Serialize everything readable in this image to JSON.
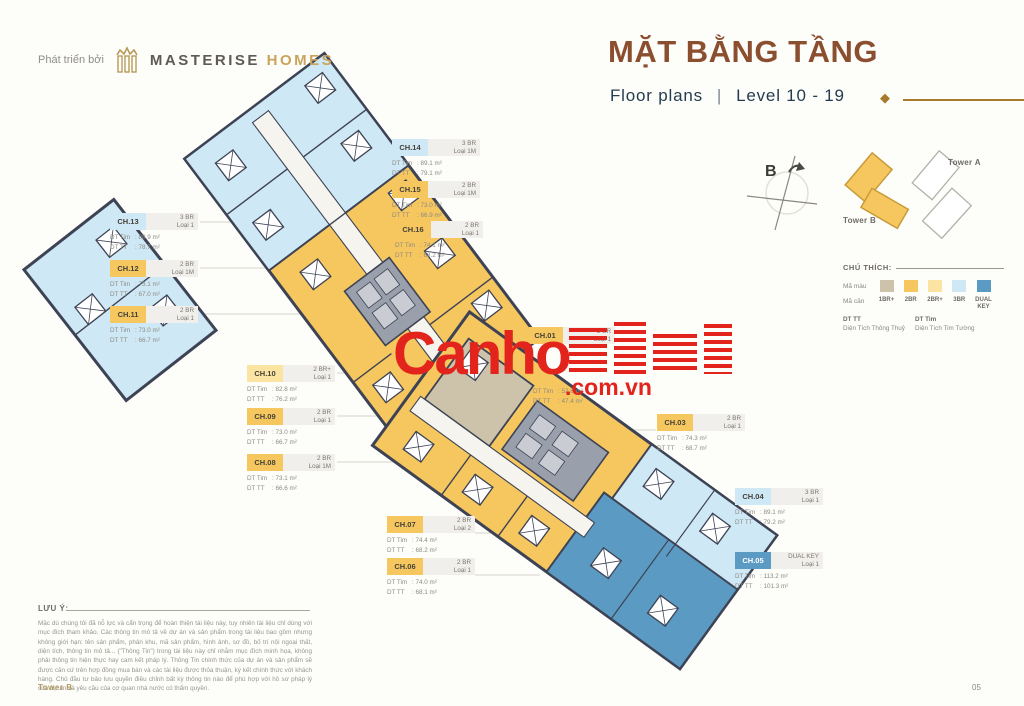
{
  "page": {
    "developer_prefix": "Phát triển bởi",
    "brand_primary": "MASTERISE",
    "brand_secondary": "HOMES",
    "title": "MẶT BẰNG TẦNG",
    "subtitle_left": "Floor plans",
    "subtitle_divider": "|",
    "subtitle_right": "Level 10 - 19",
    "footer_left": "Tower B",
    "page_number": "05"
  },
  "minimap": {
    "compass_label": "B",
    "tower_b_label": "Tower B",
    "tower_a_label": "Tower A"
  },
  "legend": {
    "title": "CHÚ THÍCH:",
    "color_row_label": "Mã màu",
    "code_row_label": "Mã căn",
    "types": [
      {
        "label": "1BR+",
        "color": "#cdc3ab"
      },
      {
        "label": "2BR",
        "color": "#f6c75f"
      },
      {
        "label": "2BR+",
        "color": "#fbe3a2"
      },
      {
        "label": "3BR",
        "color": "#cfe8f6"
      },
      {
        "label": "DUAL KEY",
        "color": "#5b9ac2"
      }
    ],
    "dt_tt_abbr": "DT TT",
    "dt_tt_full": "Diện Tích Thông Thuỷ",
    "dt_tim_abbr": "DT Tim",
    "dt_tim_full": "Diện Tích Tim Tường"
  },
  "watermark": {
    "text_main": "Canho",
    "text_suffix": ".com.vn"
  },
  "units": [
    {
      "id": "ch14",
      "code": "CH.14",
      "type": "3 BR",
      "loai": "Loại 1M",
      "dt_tim": "89.1 m²",
      "dt_tt": "79.1 m²",
      "color": "#cfe8f6"
    },
    {
      "id": "ch15",
      "code": "CH.15",
      "type": "2 BR",
      "loai": "Loại 1M",
      "dt_tim": "73.0 m²",
      "dt_tt": "66.9 m²",
      "color": "#f6c75f"
    },
    {
      "id": "ch16",
      "code": "CH.16",
      "type": "2 BR",
      "loai": "Loại 1",
      "dt_tim": "74.1 m²",
      "dt_tt": "68.2 m²",
      "color": "#f6c75f"
    },
    {
      "id": "ch13",
      "code": "CH.13",
      "type": "3 BR",
      "loai": "Loại 1",
      "dt_tim": "88.9 m²",
      "dt_tt": "78.7 m²",
      "color": "#cfe8f6"
    },
    {
      "id": "ch12",
      "code": "CH.12",
      "type": "2 BR",
      "loai": "Loại 1M",
      "dt_tim": "73.1 m²",
      "dt_tt": "67.0 m²",
      "color": "#f6c75f"
    },
    {
      "id": "ch11",
      "code": "CH.11",
      "type": "2 BR",
      "loai": "Loại 1",
      "dt_tim": "73.0 m²",
      "dt_tt": "66.7 m²",
      "color": "#f6c75f"
    },
    {
      "id": "ch10",
      "code": "CH.10",
      "type": "2 BR+",
      "loai": "Loại 1",
      "dt_tim": "82.8 m²",
      "dt_tt": "76.2 m²",
      "color": "#fbe3a2"
    },
    {
      "id": "ch09",
      "code": "CH.09",
      "type": "2 BR",
      "loai": "Loại 1",
      "dt_tim": "73.0 m²",
      "dt_tt": "66.7 m²",
      "color": "#f6c75f"
    },
    {
      "id": "ch08",
      "code": "CH.08",
      "type": "2 BR",
      "loai": "Loại 1M",
      "dt_tim": "73.1 m²",
      "dt_tt": "66.6 m²",
      "color": "#f6c75f"
    },
    {
      "id": "ch01",
      "code": "CH.01",
      "type": "2 BR",
      "loai": "Loại 1",
      "dt_tim": "",
      "dt_tt": "",
      "color": "#f6c75f"
    },
    {
      "id": "ch02",
      "code": "",
      "type": "",
      "loai": "",
      "dt_tim": "52.8 m²",
      "dt_tt": "47.4 m²",
      "color": ""
    },
    {
      "id": "ch03",
      "code": "CH.03",
      "type": "2 BR",
      "loai": "Loại 1",
      "dt_tim": "74.3 m²",
      "dt_tt": "68.7 m²",
      "color": "#f6c75f"
    },
    {
      "id": "ch04",
      "code": "CH.04",
      "type": "3 BR",
      "loai": "Loại 1",
      "dt_tim": "89.1 m²",
      "dt_tt": "79.2 m²",
      "color": "#cfe8f6"
    },
    {
      "id": "ch05",
      "code": "CH.05",
      "type": "DUAL KEY",
      "loai": "Loại 1",
      "dt_tim": "113.2 m²",
      "dt_tt": "101.3 m²",
      "color": "#5b9ac2",
      "text_color": "#ffffff"
    },
    {
      "id": "ch07",
      "code": "CH.07",
      "type": "2 BR",
      "loai": "Loại 2",
      "dt_tim": "74.4 m²",
      "dt_tt": "68.2 m²",
      "color": "#f6c75f"
    },
    {
      "id": "ch06",
      "code": "CH.06",
      "type": "2 BR",
      "loai": "Loại 1",
      "dt_tim": "74.0 m²",
      "dt_tt": "68.1 m²",
      "color": "#f6c75f"
    }
  ],
  "note": {
    "title": "LƯU Ý:",
    "body": "Mặc dù chúng tôi đã nỗ lực và cẩn trọng để hoàn thiện tài liệu này, tuy nhiên tài liệu chỉ dùng với mục đích tham khảo. Các thông tin mô tả về dự án và sản phẩm trong tài liệu bao gồm nhưng không giới hạn: tên sản phẩm, phân khu, mã sản phẩm, hình ảnh, sơ đồ, bố trí nội ngoại thất, diện tích, thông tin mô tả... (\"Thông Tin\") trong tài liệu này chỉ nhằm mục đích minh họa, không phải thông tin hiện thực hay cam kết pháp lý. Thông Tin chính thức của dự án và sản phẩm sẽ được căn cứ trên hợp đồng mua bán và các tài liệu được thỏa thuận, ký kết chính thức với khách hàng. Chủ đầu tư bảo lưu quyền điều chỉnh bất kỳ thông tin nào để phù hợp với hồ sơ pháp lý của dự án và yêu cầu của cơ quan nhà nước có thẩm quyền."
  }
}
